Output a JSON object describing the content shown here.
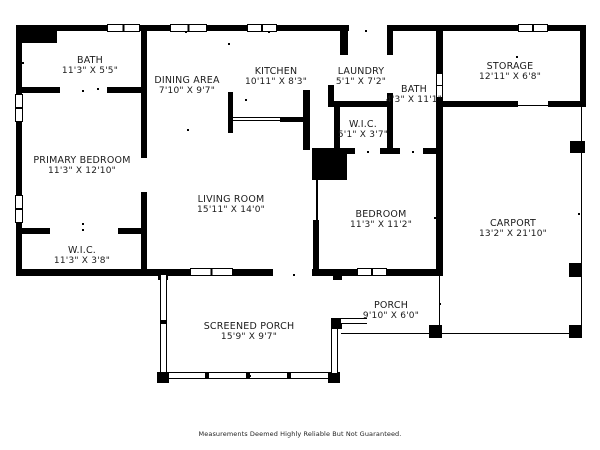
{
  "plan": {
    "rooms": [
      {
        "id": "bath-left",
        "name": "BATH",
        "dims": "11'3\" X 5'5\""
      },
      {
        "id": "dining-area",
        "name": "DINING AREA",
        "dims": "7'10\" X 9'7\""
      },
      {
        "id": "kitchen",
        "name": "KITCHEN",
        "dims": "10'11\" X 8'3\""
      },
      {
        "id": "laundry",
        "name": "LAUNDRY",
        "dims": "5'1\" X 7'2\""
      },
      {
        "id": "bath-middle",
        "name": "BATH",
        "dims": "4'3\" X 11'1\""
      },
      {
        "id": "storage",
        "name": "STORAGE",
        "dims": "12'11\" X 6'8\""
      },
      {
        "id": "wic-middle",
        "name": "W.I.C.",
        "dims": "5'1\" X 3'7\""
      },
      {
        "id": "primary-bedroom",
        "name": "PRIMARY BEDROOM",
        "dims": "11'3\" X 12'10\""
      },
      {
        "id": "living-room",
        "name": "LIVING ROOM",
        "dims": "15'11\" X 14'0\""
      },
      {
        "id": "bedroom",
        "name": "BEDROOM",
        "dims": "11'3\" X 11'2\""
      },
      {
        "id": "carport",
        "name": "CARPORT",
        "dims": "13'2\" X 21'10\""
      },
      {
        "id": "wic-left",
        "name": "W.I.C.",
        "dims": "11'3\" X 3'8\""
      },
      {
        "id": "screened-porch",
        "name": "SCREENED PORCH",
        "dims": "15'9\" X 9'7\""
      },
      {
        "id": "porch",
        "name": "PORCH",
        "dims": "9'10\" X 6'0\""
      }
    ],
    "wall_color": "#000000",
    "background_color": "#ffffff",
    "disclaimer": "Measurements Deemed Highly Reliable But Not Guaranteed."
  }
}
